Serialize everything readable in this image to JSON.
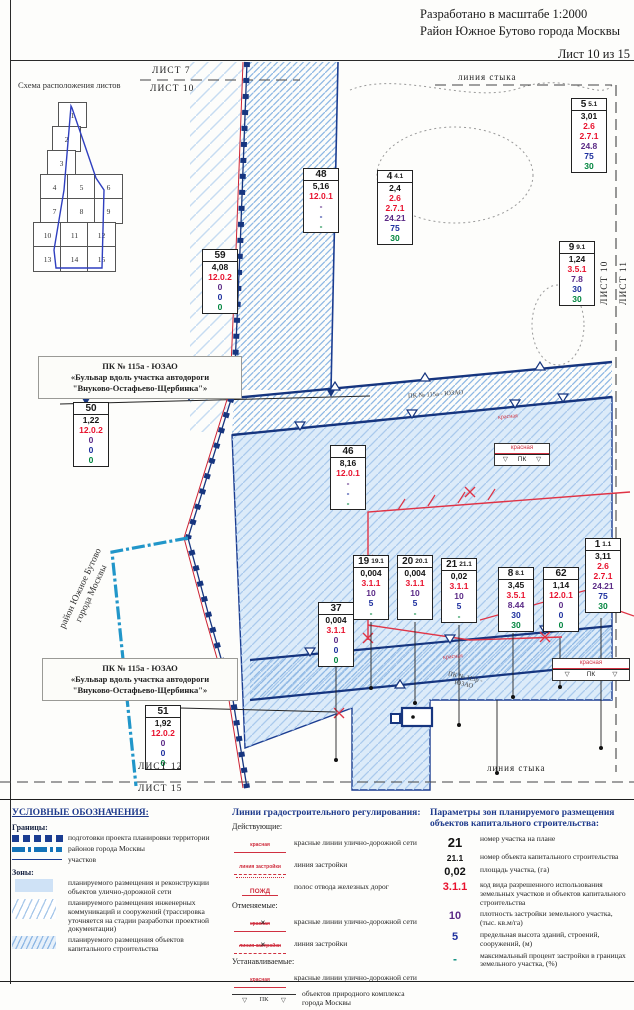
{
  "header": {
    "scale_note": "Разработано в масштабе 1:2000",
    "district": "Район Южное Бутово города Москвы",
    "sheet_note": "Лист 10 из 15"
  },
  "schema": {
    "title": "Схема расположения листов",
    "cells": [
      {
        "n": "1",
        "x": 44,
        "y": 12
      },
      {
        "n": "2",
        "x": 38,
        "y": 36
      },
      {
        "n": "3",
        "x": 33,
        "y": 60
      },
      {
        "n": "4",
        "x": 26,
        "y": 84
      },
      {
        "n": "5",
        "x": 53,
        "y": 84
      },
      {
        "n": "6",
        "x": 80,
        "y": 84
      },
      {
        "n": "7",
        "x": 26,
        "y": 108
      },
      {
        "n": "8",
        "x": 53,
        "y": 108
      },
      {
        "n": "9",
        "x": 80,
        "y": 108
      },
      {
        "n": "10",
        "x": 19,
        "y": 132
      },
      {
        "n": "11",
        "x": 46,
        "y": 132
      },
      {
        "n": "12",
        "x": 73,
        "y": 132
      },
      {
        "n": "13",
        "x": 19,
        "y": 156
      },
      {
        "n": "14",
        "x": 46,
        "y": 156
      },
      {
        "n": "15",
        "x": 73,
        "y": 156
      }
    ]
  },
  "map": {
    "labels": {
      "list7": "ЛИСТ 7",
      "list10_top": "ЛИСТ 10",
      "styka_top": "линия стыка",
      "list10_right": "ЛИСТ 10",
      "list11_right": "ЛИСТ 11",
      "district_line1": "район Южное Бутово",
      "district_line2": "города Москвы",
      "pk115a_inline": "ПК № 115а - ЮЗАО",
      "krasnaya_inline1": "красная",
      "krasnaya_inline2": "красная",
      "pk115r_line1": "ПК № 115р -",
      "pk115r_line2": "ЮЗАО",
      "list12": "ЛИСТ 12",
      "list15": "ЛИСТ 15",
      "styka_bottom": "линия стыка"
    },
    "marker": {
      "red_label": "красная",
      "pk_label": "ПК"
    },
    "callout": {
      "l1": "ПК № 115а - ЮЗАО",
      "l2": "«Бульвар вдоль участка автодороги",
      "l3": "\"Внуково-Остафьево-Щербинка\"»"
    },
    "parcels": [
      {
        "num": "48",
        "sup": "",
        "x": 303,
        "y": 108,
        "rows": [
          [
            "5,16",
            "k"
          ],
          [
            "12.0.1",
            "r"
          ],
          [
            "-",
            "p"
          ],
          [
            "-",
            "b"
          ],
          [
            "-",
            "g"
          ]
        ]
      },
      {
        "num": "4",
        "sup": "4.1",
        "x": 377,
        "y": 110,
        "rows": [
          [
            "2,4",
            "k"
          ],
          [
            "2.6",
            "r"
          ],
          [
            "2.7.1",
            "r"
          ],
          [
            "24.21",
            "p"
          ],
          [
            "75",
            "b"
          ],
          [
            "30",
            "g"
          ]
        ]
      },
      {
        "num": "5",
        "sup": "5.1",
        "x": 571,
        "y": 38,
        "rows": [
          [
            "3,01",
            "k"
          ],
          [
            "2.6",
            "r"
          ],
          [
            "2.7.1",
            "r"
          ],
          [
            "24.8",
            "p"
          ],
          [
            "75",
            "b"
          ],
          [
            "30",
            "g"
          ]
        ]
      },
      {
        "num": "9",
        "sup": "9.1",
        "x": 559,
        "y": 181,
        "rows": [
          [
            "1,24",
            "k"
          ],
          [
            "3.5.1",
            "r"
          ],
          [
            "7.8",
            "p"
          ],
          [
            "30",
            "b"
          ],
          [
            "30",
            "g"
          ]
        ]
      },
      {
        "num": "59",
        "sup": "",
        "x": 202,
        "y": 189,
        "rows": [
          [
            "4,08",
            "k"
          ],
          [
            "12.0.2",
            "r"
          ],
          [
            "0",
            "p"
          ],
          [
            "0",
            "b"
          ],
          [
            "0",
            "g"
          ]
        ]
      },
      {
        "num": "50",
        "sup": "",
        "x": 73,
        "y": 342,
        "rows": [
          [
            "1,22",
            "k"
          ],
          [
            "12.0.2",
            "r"
          ],
          [
            "0",
            "p"
          ],
          [
            "0",
            "b"
          ],
          [
            "0",
            "g"
          ]
        ]
      },
      {
        "num": "46",
        "sup": "",
        "x": 330,
        "y": 385,
        "rows": [
          [
            "8,16",
            "k"
          ],
          [
            "12.0.1",
            "r"
          ],
          [
            "-",
            "p"
          ],
          [
            "-",
            "b"
          ],
          [
            "-",
            "g"
          ]
        ]
      },
      {
        "num": "19",
        "sup": "19.1",
        "x": 353,
        "y": 495,
        "rows": [
          [
            "0,004",
            "k"
          ],
          [
            "3.1.1",
            "r"
          ],
          [
            "10",
            "p"
          ],
          [
            "5",
            "b"
          ],
          [
            "-",
            "g"
          ]
        ]
      },
      {
        "num": "20",
        "sup": "20.1",
        "x": 397,
        "y": 495,
        "rows": [
          [
            "0,004",
            "k"
          ],
          [
            "3.1.1",
            "r"
          ],
          [
            "10",
            "p"
          ],
          [
            "5",
            "b"
          ],
          [
            "-",
            "g"
          ]
        ]
      },
      {
        "num": "21",
        "sup": "21.1",
        "x": 441,
        "y": 498,
        "rows": [
          [
            "0,02",
            "k"
          ],
          [
            "3.1.1",
            "r"
          ],
          [
            "10",
            "p"
          ],
          [
            "5",
            "b"
          ],
          [
            "-",
            "g"
          ]
        ]
      },
      {
        "num": "8",
        "sup": "8.1",
        "x": 498,
        "y": 507,
        "rows": [
          [
            "3,45",
            "k"
          ],
          [
            "3.5.1",
            "r"
          ],
          [
            "8.44",
            "p"
          ],
          [
            "30",
            "b"
          ],
          [
            "30",
            "g"
          ]
        ]
      },
      {
        "num": "62",
        "sup": "",
        "x": 543,
        "y": 507,
        "rows": [
          [
            "1,14",
            "k"
          ],
          [
            "12.0.1",
            "r"
          ],
          [
            "0",
            "p"
          ],
          [
            "0",
            "b"
          ],
          [
            "0",
            "g"
          ]
        ]
      },
      {
        "num": "1",
        "sup": "1.1",
        "x": 585,
        "y": 478,
        "rows": [
          [
            "3,11",
            "k"
          ],
          [
            "2.6",
            "r"
          ],
          [
            "2.7.1",
            "r"
          ],
          [
            "24.21",
            "p"
          ],
          [
            "75",
            "b"
          ],
          [
            "30",
            "g"
          ]
        ]
      },
      {
        "num": "37",
        "sup": "",
        "x": 318,
        "y": 542,
        "rows": [
          [
            "0,004",
            "k"
          ],
          [
            "3.1.1",
            "r"
          ],
          [
            "0",
            "p"
          ],
          [
            "0",
            "b"
          ],
          [
            "0",
            "g"
          ]
        ]
      },
      {
        "num": "51",
        "sup": "",
        "x": 145,
        "y": 645,
        "rows": [
          [
            "1,92",
            "k"
          ],
          [
            "12.0.2",
            "r"
          ],
          [
            "0",
            "p"
          ],
          [
            "0",
            "b"
          ],
          [
            "0",
            "g"
          ]
        ]
      }
    ]
  },
  "legend": {
    "left": {
      "title": "УСЛОВНЫЕ ОБОЗНАЧЕНИЯ:",
      "group1": "Границы:",
      "group2": "Зоны:",
      "rows": [
        {
          "label": "подготовки проекта планировки территории"
        },
        {
          "label": "районов города Москвы"
        },
        {
          "label": "участков"
        },
        {
          "label": "планируемого размещения и реконструкции объектов улично-дорожной сети"
        },
        {
          "label": "планируемого размещения инженерных коммуникаций и сооружений (трассировка уточняется на стадии разработки проектной документации)"
        },
        {
          "label": "планируемого размещения объектов капитального строительства"
        }
      ]
    },
    "middle": {
      "title": "Линии градостроительного регулирования:",
      "g1": "Действующие:",
      "g2": "Отменяемые:",
      "g3": "Устанавливаемые:",
      "rows": [
        {
          "sample": "красная",
          "label": "красные линии улично-дорожной сети"
        },
        {
          "sample": "линия застройки",
          "label": "линия застройки"
        },
        {
          "sample": "ПОЖД",
          "label": "полос отвода железных дорог"
        },
        {
          "sample": "красная",
          "label": "красные линии улично-дорожной сети"
        },
        {
          "sample": "линия застройки",
          "label": "линия застройки"
        },
        {
          "sample": "красная",
          "label": "красные линии улично-дорожной сети"
        },
        {
          "sample": "ПК",
          "label": "объектов природного комплекса города Москвы"
        }
      ]
    },
    "right": {
      "title": "Параметры зон планируемого размещения объектов капитального строительства:",
      "rows": [
        {
          "v": "21",
          "label": "номер участка на плане"
        },
        {
          "v": "21.1",
          "label": "номер объекта капитального строительства"
        },
        {
          "v": "0,02",
          "label": "площадь участка, (га)"
        },
        {
          "v": "3.1.1",
          "label": "код вида разрешенного использования земельных участков и объектов капитального строительства"
        },
        {
          "v": "10",
          "label": "плотность застройки земельного участка, (тыс. кв.м/га)"
        },
        {
          "v": "5",
          "label": "предельная высота зданий, строений, сооружений, (м)"
        },
        {
          "v": "-",
          "label": "максимальный процент застройки в границах земельного участка, (%)"
        }
      ]
    }
  }
}
